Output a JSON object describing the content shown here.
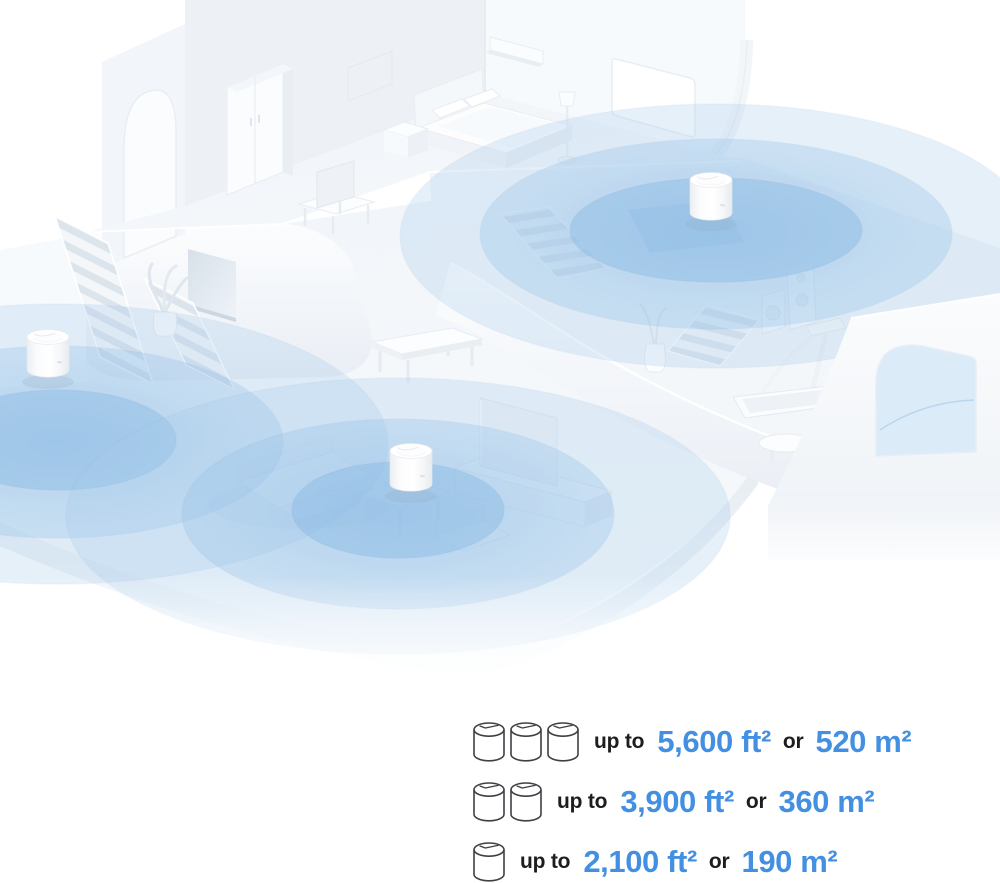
{
  "meta": {
    "alt": "Isometric white home interior with three mesh Wi-Fi units broadcasting blue coverage circles"
  },
  "palette": {
    "accent_blue": "#4390E2",
    "coverage_blue": "#8FBCE4",
    "text_dark": "#1D1D1F",
    "background": "#FFFFFF"
  },
  "illustration": {
    "routers": [
      {
        "id": "deco-router-left"
      },
      {
        "id": "deco-router-upper"
      },
      {
        "id": "deco-router-living"
      }
    ]
  },
  "legend": {
    "rows": [
      {
        "units": 3,
        "prefix": "up to",
        "area_ft": "5,600 ft²",
        "conjunction": "or",
        "area_m": "520 m²"
      },
      {
        "units": 2,
        "prefix": "up to",
        "area_ft": "3,900 ft²",
        "conjunction": "or",
        "area_m": "360 m²"
      },
      {
        "units": 1,
        "prefix": "up to",
        "area_ft": "2,100 ft²",
        "conjunction": "or",
        "area_m": "190 m²"
      }
    ]
  }
}
